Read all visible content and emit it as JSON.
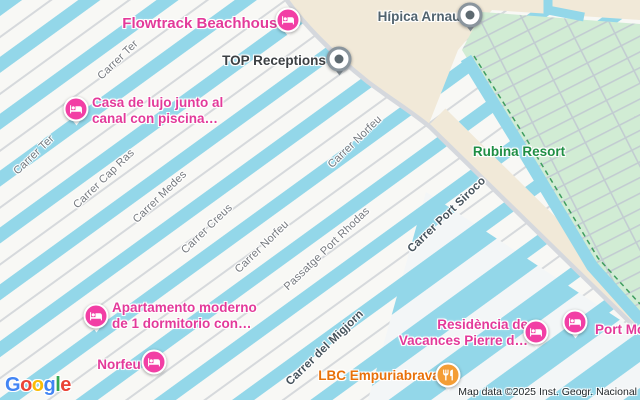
{
  "attribution": "Map data ©2025 Inst. Geogr. Nacional",
  "google_logo": {
    "letters": [
      "G",
      "o",
      "o",
      "g",
      "l",
      "e"
    ]
  },
  "streets": [
    "Carrer Ter",
    "Carrer Ter",
    "Carrer Cap Ras",
    "Carrer Medes",
    "Carrer Creus",
    "Carrer Norfeu",
    "Carrer Norfeu",
    "Passatge Port Rhodas",
    "Carrer Port Siroco",
    "Carrer del Migjorn"
  ],
  "pois": {
    "flowtrack_beachhouse": {
      "label": "Flowtrack Beachhouse",
      "category": "lodging"
    },
    "hipica_arnau": {
      "label": "Hípica Arnau",
      "category": "place"
    },
    "top_receptions": {
      "label": "TOP Receptions",
      "category": "place"
    },
    "casa_de_lujo": {
      "line1": "Casa de lujo junto al",
      "line2": "canal con piscina…",
      "category": "lodging"
    },
    "rubina_resort": {
      "label": "Rubina Resort",
      "category": "resort-area"
    },
    "apartamento_moderno": {
      "line1": "Apartamento moderno",
      "line2": "de 1 dormitorio con…",
      "category": "lodging"
    },
    "norfeu": {
      "label": "Norfeu",
      "category": "lodging"
    },
    "residencia_pierre": {
      "line1": "Residència de",
      "line2": "Vacances Pierre d…",
      "category": "lodging"
    },
    "port_mo": {
      "label": "Port Mo",
      "category": "lodging"
    },
    "lbc_empuriabrava": {
      "label": "LBC Empuriabrava",
      "category": "restaurant"
    }
  },
  "colors": {
    "canal_water": "#93d7e9",
    "lodging_pink": "#e33a9a",
    "restaurant_orange": "#e8710a",
    "resort_green_text": "#1f8e44",
    "park_green": "#d1ecd4",
    "sand_tan": "#f1e9d8"
  }
}
